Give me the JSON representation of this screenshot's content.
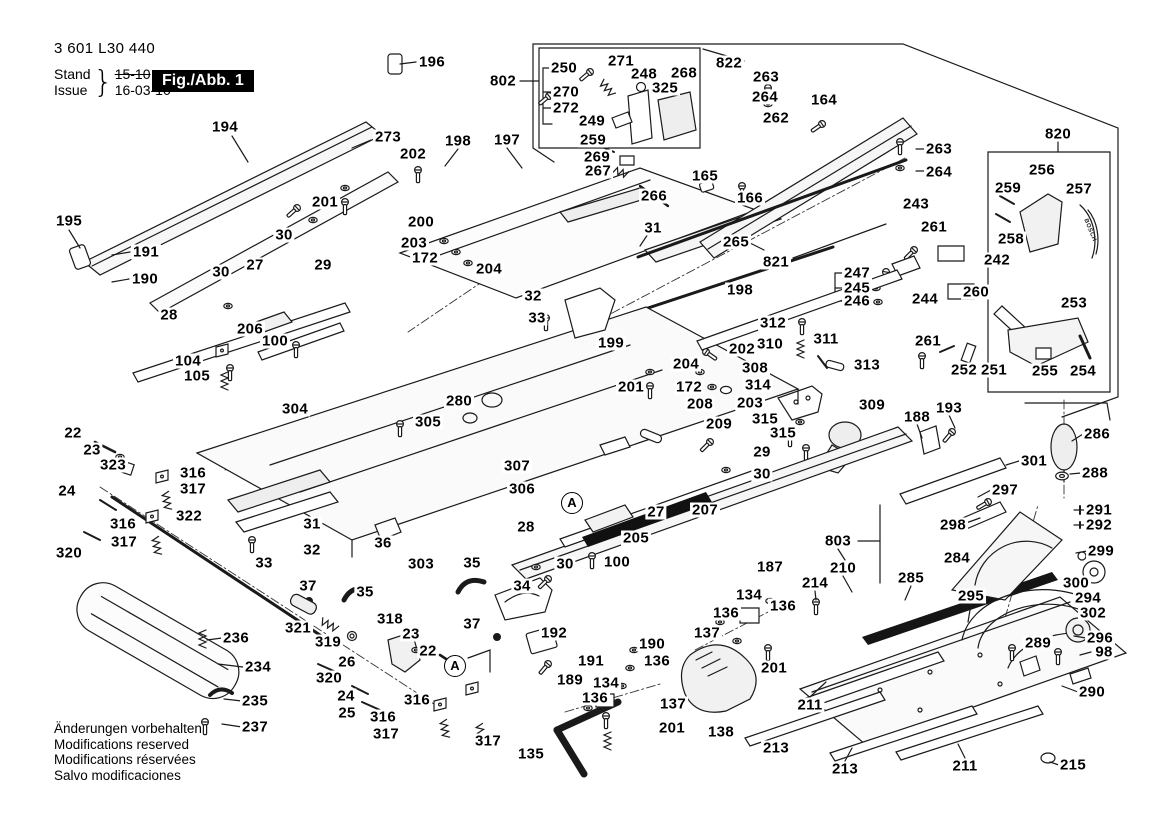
{
  "meta": {
    "part_number": "3 601 L30 440",
    "stand_label": "Stand",
    "issue_label": "Issue",
    "brace": "}",
    "old_date": "15-10",
    "new_date": "16-03-10",
    "figure_label": "Fig./Abb. 1"
  },
  "footer": {
    "lines": [
      "Änderungen vorbehalten",
      "Modifications reserved",
      "Modifications réservées",
      "Salvo modificaciones"
    ]
  },
  "brand_text": "BOSCH",
  "assembly_markers": [
    {
      "t": "A",
      "x": 572,
      "y": 503
    },
    {
      "t": "A",
      "x": 455,
      "y": 666
    }
  ],
  "callouts": [
    {
      "t": "196",
      "x": 432,
      "y": 62
    },
    {
      "t": "194",
      "x": 225,
      "y": 127
    },
    {
      "t": "273",
      "x": 388,
      "y": 137
    },
    {
      "t": "202",
      "x": 413,
      "y": 154
    },
    {
      "t": "198",
      "x": 458,
      "y": 141
    },
    {
      "t": "197",
      "x": 507,
      "y": 140
    },
    {
      "t": "802",
      "x": 503,
      "y": 81
    },
    {
      "t": "250",
      "x": 564,
      "y": 68
    },
    {
      "t": "271",
      "x": 621,
      "y": 61
    },
    {
      "t": "248",
      "x": 644,
      "y": 74
    },
    {
      "t": "268",
      "x": 684,
      "y": 73
    },
    {
      "t": "822",
      "x": 729,
      "y": 63
    },
    {
      "t": "325",
      "x": 665,
      "y": 88
    },
    {
      "t": "263",
      "x": 766,
      "y": 77
    },
    {
      "t": "264",
      "x": 765,
      "y": 97
    },
    {
      "t": "164",
      "x": 824,
      "y": 100
    },
    {
      "t": "270",
      "x": 566,
      "y": 92
    },
    {
      "t": "272",
      "x": 566,
      "y": 108
    },
    {
      "t": "249",
      "x": 592,
      "y": 121
    },
    {
      "t": "262",
      "x": 776,
      "y": 118
    },
    {
      "t": "259",
      "x": 593,
      "y": 140
    },
    {
      "t": "269",
      "x": 597,
      "y": 157
    },
    {
      "t": "267",
      "x": 598,
      "y": 171
    },
    {
      "t": "266",
      "x": 654,
      "y": 196
    },
    {
      "t": "165",
      "x": 705,
      "y": 176
    },
    {
      "t": "166",
      "x": 750,
      "y": 198
    },
    {
      "t": "263",
      "x": 939,
      "y": 149
    },
    {
      "t": "264",
      "x": 939,
      "y": 172
    },
    {
      "t": "820",
      "x": 1058,
      "y": 134
    },
    {
      "t": "256",
      "x": 1042,
      "y": 170
    },
    {
      "t": "259",
      "x": 1008,
      "y": 188
    },
    {
      "t": "257",
      "x": 1079,
      "y": 189
    },
    {
      "t": "243",
      "x": 916,
      "y": 204
    },
    {
      "t": "261",
      "x": 934,
      "y": 227
    },
    {
      "t": "258",
      "x": 1011,
      "y": 239
    },
    {
      "t": "242",
      "x": 997,
      "y": 260
    },
    {
      "t": "265",
      "x": 736,
      "y": 242
    },
    {
      "t": "821",
      "x": 776,
      "y": 262
    },
    {
      "t": "31",
      "x": 653,
      "y": 228
    },
    {
      "t": "195",
      "x": 69,
      "y": 221
    },
    {
      "t": "191",
      "x": 146,
      "y": 252
    },
    {
      "t": "190",
      "x": 145,
      "y": 279
    },
    {
      "t": "201",
      "x": 325,
      "y": 202
    },
    {
      "t": "30",
      "x": 284,
      "y": 235
    },
    {
      "t": "29",
      "x": 323,
      "y": 265
    },
    {
      "t": "27",
      "x": 255,
      "y": 265
    },
    {
      "t": "30",
      "x": 221,
      "y": 272
    },
    {
      "t": "28",
      "x": 169,
      "y": 315
    },
    {
      "t": "206",
      "x": 250,
      "y": 329
    },
    {
      "t": "100",
      "x": 275,
      "y": 341
    },
    {
      "t": "104",
      "x": 188,
      "y": 361
    },
    {
      "t": "105",
      "x": 197,
      "y": 376
    },
    {
      "t": "200",
      "x": 421,
      "y": 222
    },
    {
      "t": "203",
      "x": 414,
      "y": 243
    },
    {
      "t": "172",
      "x": 425,
      "y": 258
    },
    {
      "t": "204",
      "x": 489,
      "y": 269
    },
    {
      "t": "32",
      "x": 533,
      "y": 296
    },
    {
      "t": "33",
      "x": 537,
      "y": 318
    },
    {
      "t": "199",
      "x": 611,
      "y": 343
    },
    {
      "t": "198",
      "x": 740,
      "y": 290
    },
    {
      "t": "202",
      "x": 742,
      "y": 349
    },
    {
      "t": "204",
      "x": 686,
      "y": 364
    },
    {
      "t": "172",
      "x": 689,
      "y": 387
    },
    {
      "t": "201",
      "x": 631,
      "y": 387
    },
    {
      "t": "203",
      "x": 750,
      "y": 403
    },
    {
      "t": "208",
      "x": 700,
      "y": 404
    },
    {
      "t": "209",
      "x": 719,
      "y": 424
    },
    {
      "t": "247",
      "x": 857,
      "y": 273
    },
    {
      "t": "245",
      "x": 857,
      "y": 288
    },
    {
      "t": "246",
      "x": 857,
      "y": 301
    },
    {
      "t": "244",
      "x": 925,
      "y": 299
    },
    {
      "t": "260",
      "x": 976,
      "y": 292
    },
    {
      "t": "261",
      "x": 928,
      "y": 341
    },
    {
      "t": "312",
      "x": 773,
      "y": 323
    },
    {
      "t": "310",
      "x": 770,
      "y": 344
    },
    {
      "t": "311",
      "x": 826,
      "y": 339
    },
    {
      "t": "313",
      "x": 867,
      "y": 365
    },
    {
      "t": "308",
      "x": 755,
      "y": 368
    },
    {
      "t": "314",
      "x": 758,
      "y": 385
    },
    {
      "t": "315",
      "x": 765,
      "y": 419
    },
    {
      "t": "315",
      "x": 783,
      "y": 433
    },
    {
      "t": "309",
      "x": 872,
      "y": 405
    },
    {
      "t": "188",
      "x": 917,
      "y": 417
    },
    {
      "t": "193",
      "x": 949,
      "y": 408
    },
    {
      "t": "252",
      "x": 964,
      "y": 370
    },
    {
      "t": "251",
      "x": 994,
      "y": 370
    },
    {
      "t": "255",
      "x": 1045,
      "y": 371
    },
    {
      "t": "254",
      "x": 1083,
      "y": 371
    },
    {
      "t": "253",
      "x": 1074,
      "y": 303
    },
    {
      "t": "304",
      "x": 295,
      "y": 409
    },
    {
      "t": "305",
      "x": 428,
      "y": 422
    },
    {
      "t": "280",
      "x": 459,
      "y": 401
    },
    {
      "t": "307",
      "x": 517,
      "y": 466
    },
    {
      "t": "306",
      "x": 522,
      "y": 489
    },
    {
      "t": "29",
      "x": 762,
      "y": 452
    },
    {
      "t": "30",
      "x": 762,
      "y": 474
    },
    {
      "t": "27",
      "x": 656,
      "y": 512
    },
    {
      "t": "207",
      "x": 705,
      "y": 510
    },
    {
      "t": "28",
      "x": 526,
      "y": 527
    },
    {
      "t": "205",
      "x": 636,
      "y": 538
    },
    {
      "t": "100",
      "x": 617,
      "y": 562
    },
    {
      "t": "30",
      "x": 565,
      "y": 564
    },
    {
      "t": "22",
      "x": 73,
      "y": 433
    },
    {
      "t": "23",
      "x": 92,
      "y": 450
    },
    {
      "t": "323",
      "x": 113,
      "y": 465
    },
    {
      "t": "24",
      "x": 67,
      "y": 491
    },
    {
      "t": "316",
      "x": 193,
      "y": 473
    },
    {
      "t": "317",
      "x": 193,
      "y": 489
    },
    {
      "t": "316",
      "x": 123,
      "y": 524
    },
    {
      "t": "317",
      "x": 124,
      "y": 542
    },
    {
      "t": "320",
      "x": 69,
      "y": 553
    },
    {
      "t": "322",
      "x": 189,
      "y": 516
    },
    {
      "t": "31",
      "x": 312,
      "y": 524
    },
    {
      "t": "32",
      "x": 312,
      "y": 550
    },
    {
      "t": "33",
      "x": 264,
      "y": 563
    },
    {
      "t": "36",
      "x": 383,
      "y": 543
    },
    {
      "t": "303",
      "x": 421,
      "y": 564
    },
    {
      "t": "35",
      "x": 472,
      "y": 563
    },
    {
      "t": "35",
      "x": 365,
      "y": 592
    },
    {
      "t": "37",
      "x": 308,
      "y": 586
    },
    {
      "t": "34",
      "x": 522,
      "y": 586
    },
    {
      "t": "37",
      "x": 472,
      "y": 624
    },
    {
      "t": "318",
      "x": 390,
      "y": 619
    },
    {
      "t": "321",
      "x": 298,
      "y": 628
    },
    {
      "t": "319",
      "x": 328,
      "y": 642
    },
    {
      "t": "26",
      "x": 347,
      "y": 662
    },
    {
      "t": "23",
      "x": 411,
      "y": 634
    },
    {
      "t": "22",
      "x": 428,
      "y": 651
    },
    {
      "t": "320",
      "x": 329,
      "y": 678
    },
    {
      "t": "24",
      "x": 346,
      "y": 696
    },
    {
      "t": "25",
      "x": 347,
      "y": 713
    },
    {
      "t": "316",
      "x": 417,
      "y": 700
    },
    {
      "t": "316",
      "x": 383,
      "y": 717
    },
    {
      "t": "317",
      "x": 386,
      "y": 734
    },
    {
      "t": "317",
      "x": 488,
      "y": 741
    },
    {
      "t": "236",
      "x": 236,
      "y": 638
    },
    {
      "t": "234",
      "x": 258,
      "y": 667
    },
    {
      "t": "235",
      "x": 255,
      "y": 701
    },
    {
      "t": "237",
      "x": 255,
      "y": 727
    },
    {
      "t": "192",
      "x": 554,
      "y": 633
    },
    {
      "t": "190",
      "x": 652,
      "y": 644
    },
    {
      "t": "191",
      "x": 591,
      "y": 661
    },
    {
      "t": "189",
      "x": 570,
      "y": 680
    },
    {
      "t": "134",
      "x": 606,
      "y": 683
    },
    {
      "t": "136",
      "x": 595,
      "y": 698
    },
    {
      "t": "136",
      "x": 657,
      "y": 661
    },
    {
      "t": "137",
      "x": 673,
      "y": 704
    },
    {
      "t": "201",
      "x": 672,
      "y": 728
    },
    {
      "t": "135",
      "x": 531,
      "y": 754
    },
    {
      "t": "138",
      "x": 721,
      "y": 732
    },
    {
      "t": "213",
      "x": 776,
      "y": 748
    },
    {
      "t": "134",
      "x": 749,
      "y": 595
    },
    {
      "t": "136",
      "x": 783,
      "y": 606
    },
    {
      "t": "136",
      "x": 726,
      "y": 613
    },
    {
      "t": "137",
      "x": 707,
      "y": 633
    },
    {
      "t": "201",
      "x": 774,
      "y": 668
    },
    {
      "t": "187",
      "x": 770,
      "y": 567
    },
    {
      "t": "803",
      "x": 838,
      "y": 541
    },
    {
      "t": "210",
      "x": 843,
      "y": 568
    },
    {
      "t": "214",
      "x": 815,
      "y": 583
    },
    {
      "t": "285",
      "x": 911,
      "y": 578
    },
    {
      "t": "295",
      "x": 971,
      "y": 596
    },
    {
      "t": "211",
      "x": 810,
      "y": 705
    },
    {
      "t": "213",
      "x": 845,
      "y": 769
    },
    {
      "t": "211",
      "x": 965,
      "y": 766
    },
    {
      "t": "215",
      "x": 1073,
      "y": 765
    },
    {
      "t": "286",
      "x": 1097,
      "y": 434
    },
    {
      "t": "301",
      "x": 1034,
      "y": 461
    },
    {
      "t": "288",
      "x": 1095,
      "y": 473
    },
    {
      "t": "297",
      "x": 1005,
      "y": 490
    },
    {
      "t": "298",
      "x": 953,
      "y": 525
    },
    {
      "t": "291",
      "x": 1099,
      "y": 510
    },
    {
      "t": "292",
      "x": 1099,
      "y": 525
    },
    {
      "t": "284",
      "x": 957,
      "y": 558
    },
    {
      "t": "299",
      "x": 1101,
      "y": 551
    },
    {
      "t": "300",
      "x": 1076,
      "y": 583
    },
    {
      "t": "294",
      "x": 1088,
      "y": 598
    },
    {
      "t": "302",
      "x": 1093,
      "y": 613
    },
    {
      "t": "296",
      "x": 1100,
      "y": 638
    },
    {
      "t": "98",
      "x": 1104,
      "y": 652
    },
    {
      "t": "289",
      "x": 1038,
      "y": 643
    },
    {
      "t": "290",
      "x": 1092,
      "y": 692
    }
  ]
}
